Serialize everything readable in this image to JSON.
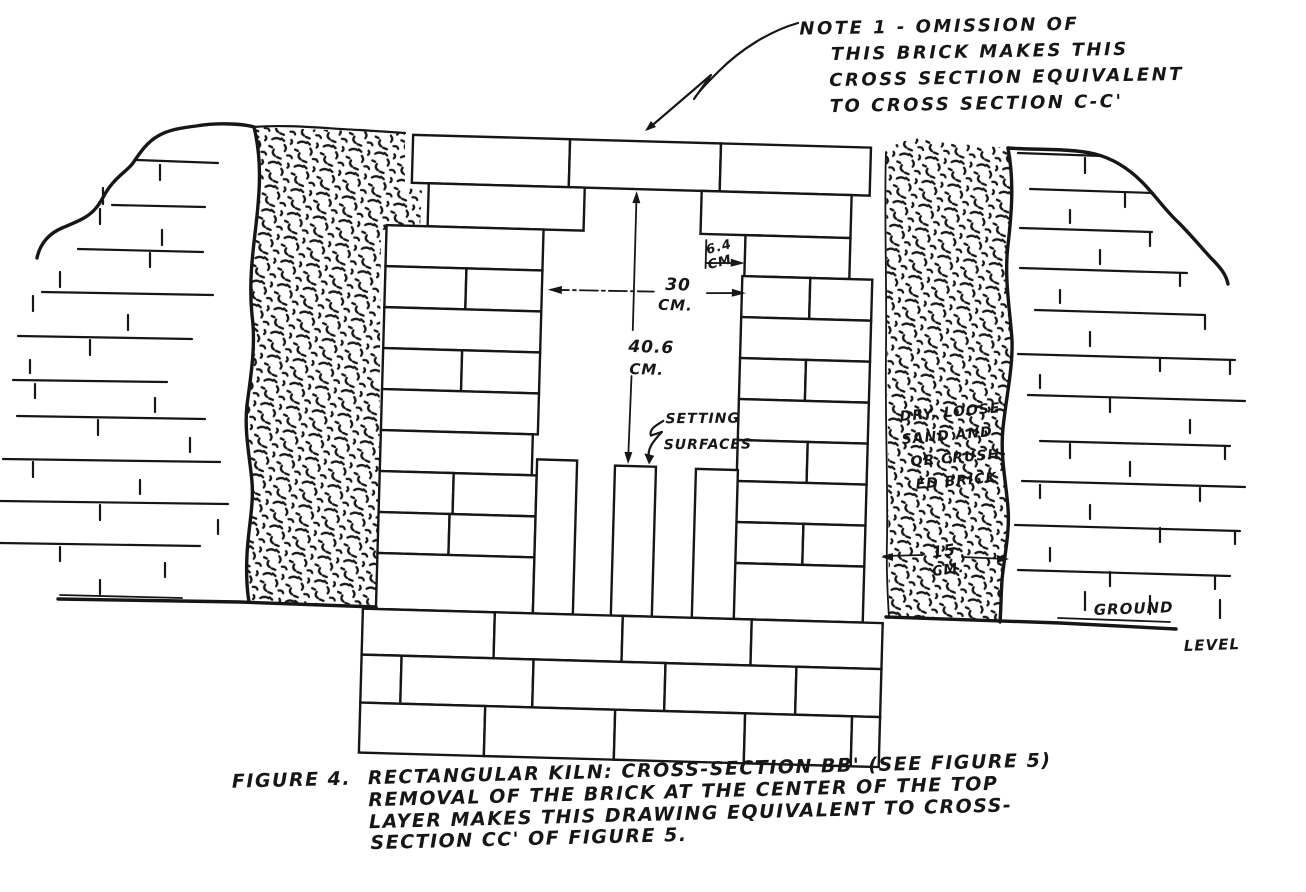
{
  "figure": {
    "note": {
      "lines": [
        "NOTE 1 - OMISSION OF",
        "THIS BRICK MAKES THIS",
        "CROSS SECTION EQUIVALENT",
        "TO CROSS SECTION C-C'"
      ]
    },
    "dimensions": {
      "flue_channel": {
        "value": "6.4",
        "unit": "CM."
      },
      "chamber_width": {
        "value": "30",
        "unit": "CM."
      },
      "chamber_height": {
        "value": "40.6",
        "unit": "CM."
      },
      "sand_layer": {
        "value": "15",
        "unit": "CM."
      }
    },
    "labels": {
      "setting_surfaces": {
        "line1": "SETTING",
        "line2": "SURFACES"
      },
      "sand_fill": {
        "line1": "DRY, LOOSE",
        "line2": "SAND AND",
        "line3": "OR CRUSH-",
        "line4": "ED BRICK"
      },
      "ground": "GROUND",
      "level": "LEVEL"
    },
    "caption": {
      "figure_label": "FIGURE 4.",
      "lines": [
        "RECTANGULAR KILN: CROSS-SECTION BB' (SEE FIGURE 5)",
        "REMOVAL OF THE BRICK AT THE CENTER OF THE TOP",
        "LAYER MAKES THIS DRAWING EQUIVALENT TO CROSS-",
        "SECTION CC' OF FIGURE 5."
      ]
    }
  },
  "colors": {
    "ink": "#161616",
    "paper": "#ffffff"
  }
}
